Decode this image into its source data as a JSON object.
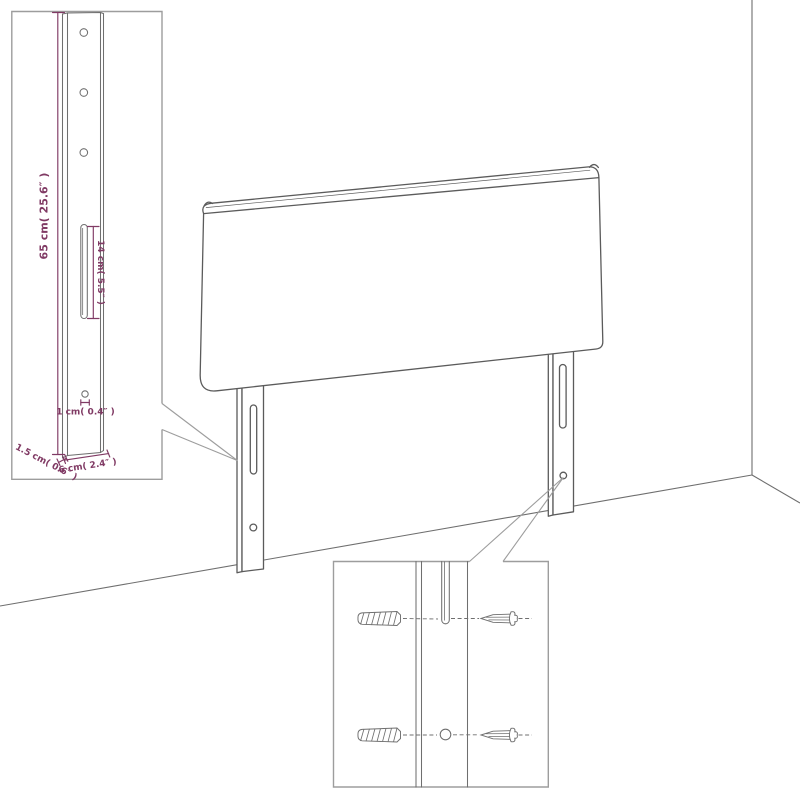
{
  "colors": {
    "background": "#ffffff",
    "furniture_line": "#5b5b5b",
    "wall_line": "#6e6e6e",
    "callout_border": "#9d9d9d",
    "detail_line": "#6f6f6f",
    "dimension": "#803a64"
  },
  "leg_detail_inset": {
    "height_label": "65 cm( 25.6″ )",
    "slot_label": "14 cm( 5.5″ )",
    "hole_label": "1 cm( 0.4″ )",
    "depth_label": "1.5 cm( 0.6″ )",
    "width_label": "6 cm( 2.4″ )"
  }
}
